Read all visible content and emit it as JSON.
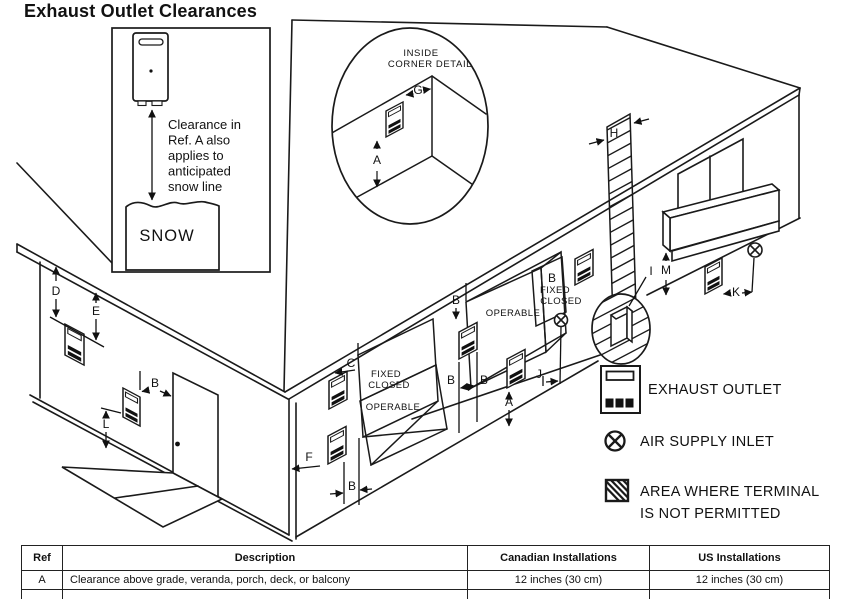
{
  "title": "Exhaust Outlet Clearances",
  "snow_inset": {
    "note": [
      "Clearance in",
      "Ref. A also",
      "applies to",
      "anticipated",
      "snow line"
    ],
    "snow_label": "SNOW"
  },
  "corner_detail": {
    "heading_line1": "INSIDE",
    "heading_line2": "CORNER DETAIL"
  },
  "dims": {
    "a": "A",
    "b": "B",
    "c": "C",
    "d": "D",
    "e": "E",
    "f": "F",
    "g": "G",
    "h": "H",
    "i": "I",
    "j": "J",
    "k": "K",
    "l": "L",
    "m": "M"
  },
  "windows": {
    "w1": {
      "line1": "FIXED",
      "line2": "CLOSED",
      "operable": "OPERABLE"
    },
    "w2": {
      "operable": "OPERABLE"
    },
    "w3": {
      "b": "B",
      "line1": "FIXED",
      "line2": "CLOSED"
    }
  },
  "legend": {
    "exhaust": "EXHAUST OUTLET",
    "air": "AIR SUPPLY INLET",
    "restricted_line1": "AREA WHERE TERMINAL",
    "restricted_line2": "IS NOT PERMITTED"
  },
  "table": {
    "headers": [
      "Ref",
      "Description",
      "Canadian Installations",
      "US Installations"
    ],
    "rows": [
      {
        "ref": "A",
        "description": "Clearance above grade, veranda, porch, deck, or balcony",
        "canadian": "12 inches (30 cm)",
        "us": "12 inches (30 cm)"
      }
    ]
  },
  "colors": {
    "line": "#1a1a1a",
    "text": "#111111"
  }
}
